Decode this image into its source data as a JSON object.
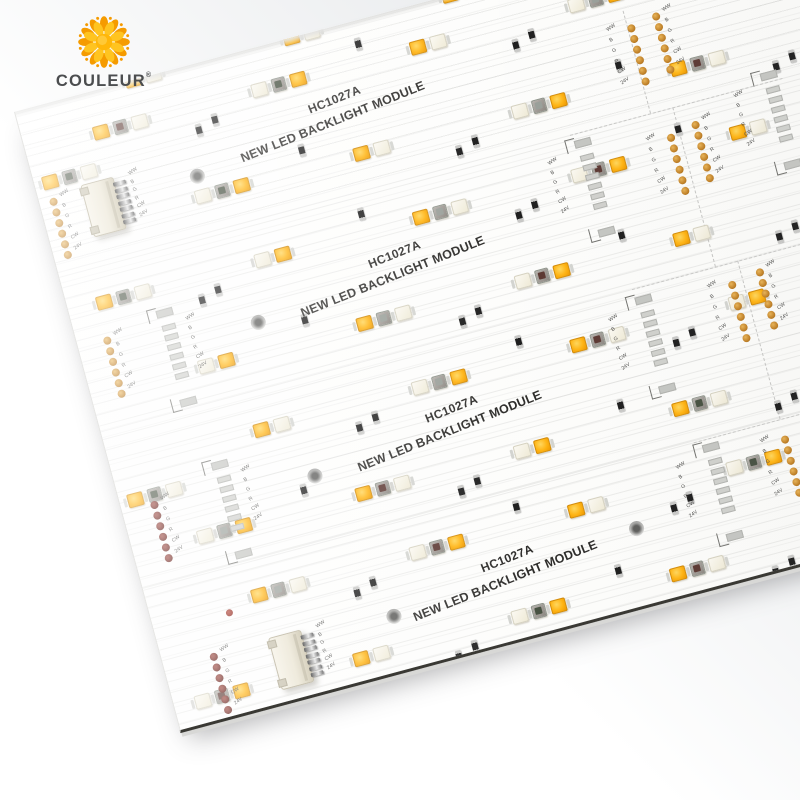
{
  "scene": {
    "description": "Product photo of a white LED backlight module PCB panel, tilted, on a light studio background"
  },
  "logo": {
    "brand": "COULEUR",
    "registered_mark": "®"
  },
  "silkscreen": {
    "part_number": "HC1027A",
    "product_name": "NEW LED BACKLIGHT MODULE"
  },
  "pin_labels": [
    "WW",
    "B",
    "G",
    "R",
    "CW",
    "24V"
  ],
  "colors": {
    "amber": "#ffb414",
    "white_led": "#efead6",
    "mid_red": "#5d3a34",
    "mid_green": "#485242",
    "via_gold": "#c08026",
    "via_dark": "#6a221c",
    "silk": "#2e2d2b",
    "logo_orange": "#f59b00",
    "logo_yellow": "#ffc420",
    "logo_text": "#4b4d4f"
  }
}
